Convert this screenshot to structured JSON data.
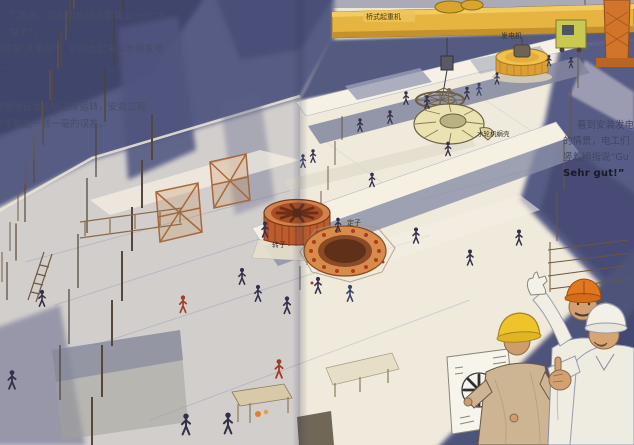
{
  "left_page": {
    "paragraph1": {
      "line1": "厂房里，巨大的机组还要装上一个“大帽子”，",
      "line2": "那就是“大电机”，它们合起来叫水轮发电",
      "line3": "机。"
    },
    "paragraph2": {
      "line1": "要想保证发电机正常运转，安装过程",
      "line2": "中不能出一丝一毫的误差。"
    }
  },
  "right_page": {
    "paragraph": {
      "line1": "看到安装发电",
      "line2": "的情景，电工们",
      "line3": "竖着拇指说“Gu",
      "line4": "Sehr gut!”"
    }
  },
  "labels": {
    "bridge_crane": "桥式起重机",
    "generator": "发电机",
    "turbine_spiral_case": "水轮机蜗壳",
    "rotor": "转子",
    "stator": "定子"
  },
  "colors": {
    "wash_blue": "#565b84",
    "deep_navy": "#40456c",
    "paper_cream": "#f0eadc",
    "crane_yellow": "#e6b440",
    "generator_yellow": "#dd9e33",
    "rotor_orange": "#bd5c2c",
    "stator_orange": "#d88c4c",
    "helmet_yellow": "#eec32b",
    "helmet_orange": "#e2771e",
    "helmet_white": "#f3f0e7"
  }
}
